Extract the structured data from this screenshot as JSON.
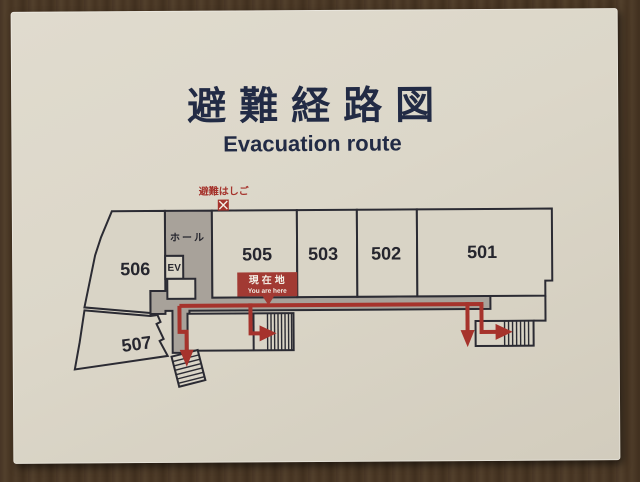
{
  "sign": {
    "title_ja": "避難経路図",
    "title_en": "Evacuation route"
  },
  "plan": {
    "ladder_label": "避難はしご",
    "hall_label": "ホール",
    "elevator_label": "EV",
    "marker": {
      "ja": "現在地",
      "en": "You are here"
    },
    "rooms": [
      "506",
      "505",
      "503",
      "502",
      "501",
      "507"
    ]
  },
  "colors": {
    "wood_wall": "#4a3827",
    "board_cream": "#d9d4c6",
    "title_navy": "#222b45",
    "outline_dark": "#2b2b33",
    "corridor_gray": "#a8a29a",
    "route_red": "#a6332c"
  }
}
